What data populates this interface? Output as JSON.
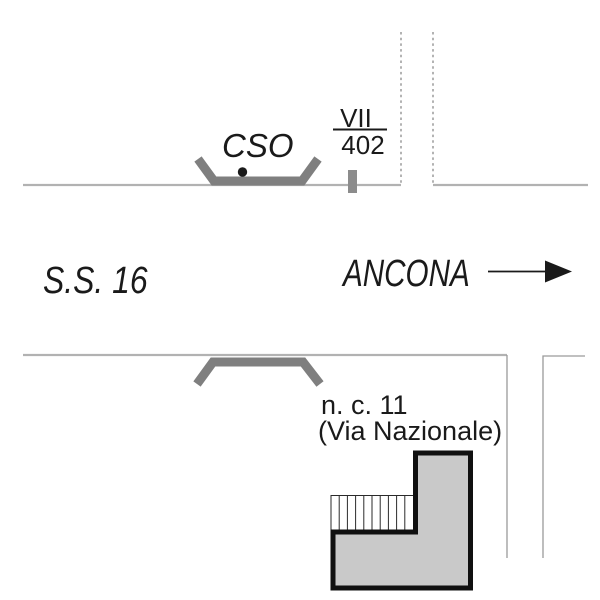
{
  "labels": {
    "cso": "CSO",
    "km_marker_numerator": "VII",
    "km_marker_denominator": "402",
    "highway": "S.S. 16",
    "direction_city": "ANCONA",
    "address_number": "n. c. 11",
    "address_street": "(Via Nazionale)"
  },
  "colors": {
    "road_line": "#b2b2b2",
    "dashed_line": "#8a8a8a",
    "gate_symbol": "#7f7f7f",
    "km_tick": "#8c8c8c",
    "building_fill": "#c9c9c9",
    "building_outline": "#101010",
    "ink": "#1a1a1a",
    "background": "#ffffff"
  },
  "symbols": {
    "direction_arrow": "solid right arrow",
    "cso_point": "filled black circle",
    "km_tick": "short vertical gray bar crossing the road line",
    "gate_upper": "gray trapezoid bracket opening upward",
    "gate_lower": "gray trapezoid bracket opening downward",
    "stairs_hatch": "rectangle with vertical hatching"
  }
}
